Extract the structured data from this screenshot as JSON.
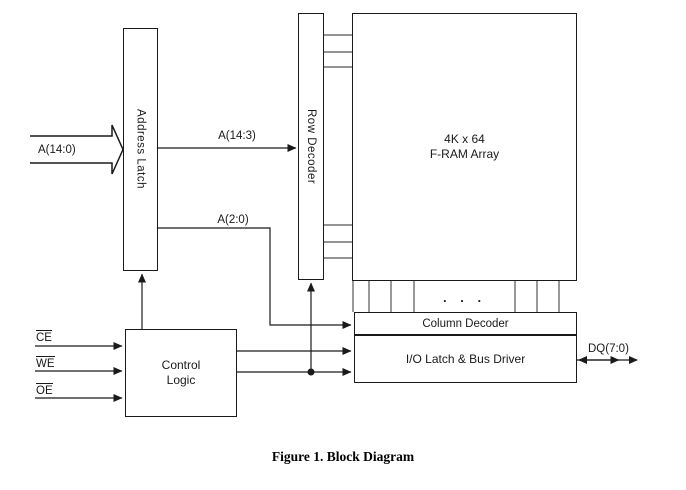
{
  "diagram": {
    "blocks": {
      "address_latch": {
        "label": "Address Latch"
      },
      "row_decoder": {
        "label": "Row Decoder"
      },
      "fram_array": {
        "line1": "4K x 64",
        "line2": "F-RAM Array"
      },
      "column_decoder": {
        "label": "Column Decoder"
      },
      "io_latch": {
        "label": "I/O Latch & Bus Driver"
      },
      "control_logic": {
        "line1": "Control",
        "line2": "Logic"
      }
    },
    "signals": {
      "address_in": "A(14:0)",
      "row_address": "A(14:3)",
      "col_address": "A(2:0)",
      "chip_enable": "CE",
      "write_enable": "WE",
      "output_enable": "OE",
      "data_bus": "DQ(7:0)"
    },
    "ellipsis": ". . .",
    "caption": "Figure 1. Block Diagram",
    "colors": {
      "line": "#1a1a1a",
      "bus_line": "#555555",
      "background": "#ffffff"
    }
  }
}
